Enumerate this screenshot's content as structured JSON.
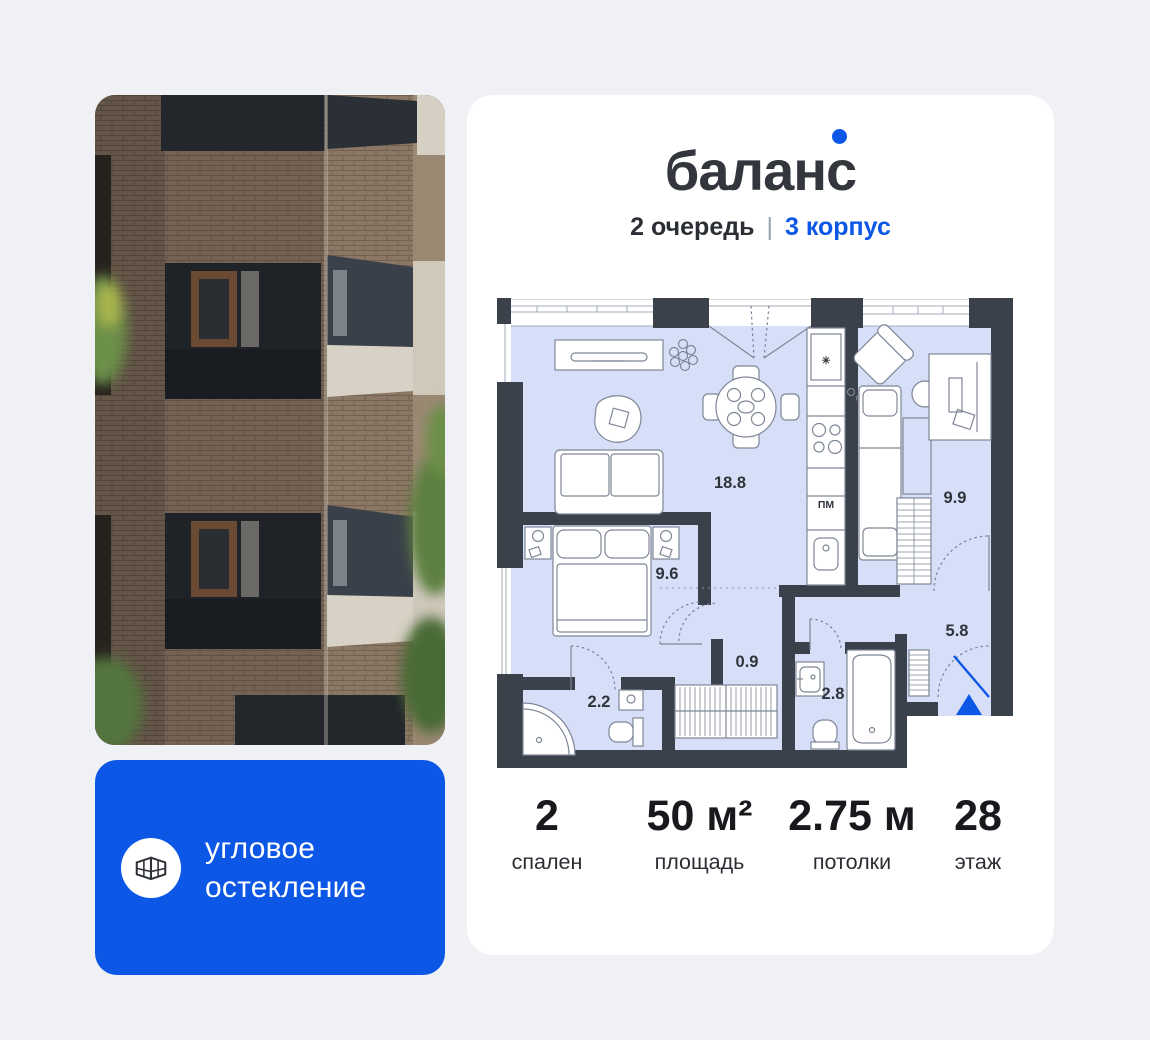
{
  "logo": {
    "name": "баланс"
  },
  "subtitle": {
    "phase": "2 очередь",
    "sep": "|",
    "building": "3 корпус"
  },
  "badge": {
    "line1": "угловое",
    "line2": "остекление"
  },
  "plan": {
    "rooms": {
      "living": "18.8",
      "bedroom": "9.6",
      "bedroom2": "9.9",
      "hall": "5.8",
      "corridor": "0.9",
      "bath": "2.8",
      "shower": "2.2",
      "pm": "ПМ"
    }
  },
  "stats": {
    "items": [
      {
        "value": "2",
        "label": "спален"
      },
      {
        "value": "50 м²",
        "label": "площадь"
      },
      {
        "value": "2.75 м",
        "label": "потолки"
      },
      {
        "value": "28",
        "label": "этаж"
      }
    ]
  },
  "colors": {
    "accent": "#0d57e6",
    "walls": "#3a414b",
    "room_fill": "#d6dff7"
  }
}
